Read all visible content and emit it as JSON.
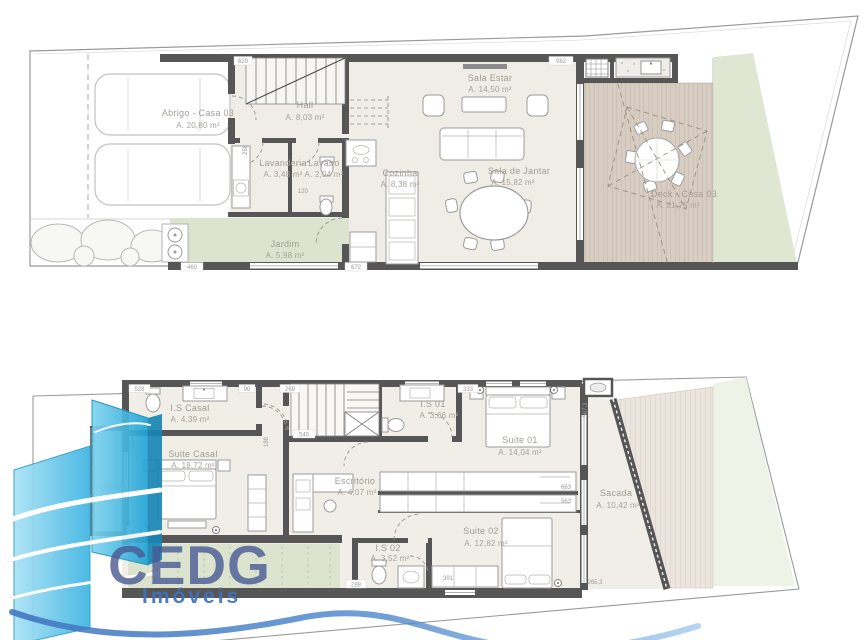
{
  "brand": {
    "name": "CEDG",
    "tagline": "Imóveis"
  },
  "ground_floor": {
    "rooms": {
      "abrigo": {
        "name": "Abrigo - Casa 03",
        "area": "A. 20,80 m²"
      },
      "hall": {
        "name": "Hall",
        "area": "A. 8,03 m²"
      },
      "lavanderia": {
        "name": "Lavanderia",
        "area": "A. 3,48 m²"
      },
      "lavabo": {
        "name": "Lavabo",
        "area": "A. 2,04 m²"
      },
      "jardim": {
        "name": "Jardim",
        "area": "A. 5,98 m²"
      },
      "cozinha": {
        "name": "Cozinha",
        "area": "A. 8,38 m²"
      },
      "sala_estar": {
        "name": "Sala Estar",
        "area": "A. 14,50 m²"
      },
      "sala_jantar": {
        "name": "Sala de Jantar",
        "area": "A. 15,82 m²"
      },
      "deck": {
        "name": "Deck - Casa 03",
        "area": "A. 21,76 m²"
      }
    },
    "dims": {
      "w982": "982",
      "w620": "620",
      "w672": "672",
      "w460": "460",
      "w258": "258",
      "w120": "120"
    }
  },
  "upper_floor": {
    "rooms": {
      "is_casal": {
        "name": "I.S Casal",
        "area": "A. 4,39 m²"
      },
      "suite_casal": {
        "name": "Suite Casal",
        "area": "A. 18,72 m²"
      },
      "sacada_frente": {
        "name": "Sacada",
        "area": "A. 2,54 m²"
      },
      "is_01": {
        "name": "I.S 01",
        "area": "A. 3,66 m²"
      },
      "suite_01": {
        "name": "Suite 01",
        "area": "A. 14,04 m²"
      },
      "escritorio": {
        "name": "Escritório",
        "area": "A. 4,07 m²"
      },
      "suite_02": {
        "name": "Suite 02",
        "area": "A. 12,82 m²"
      },
      "is_02": {
        "name": "I.S 02",
        "area": "A. 3,52 m²"
      },
      "sacada_fundos": {
        "name": "Sacada",
        "area": "A. 10,42 m²"
      }
    },
    "dims": {
      "w528": "528",
      "w90": "90",
      "w269": "269",
      "w333": "333",
      "w540": "540",
      "w139": "139",
      "w310": "310",
      "w188": "188",
      "w663": "663",
      "w563": "563",
      "w678": "678",
      "w288": "288",
      "w391": "391",
      "w265": "265,3",
      "w567": "567,3"
    }
  }
}
